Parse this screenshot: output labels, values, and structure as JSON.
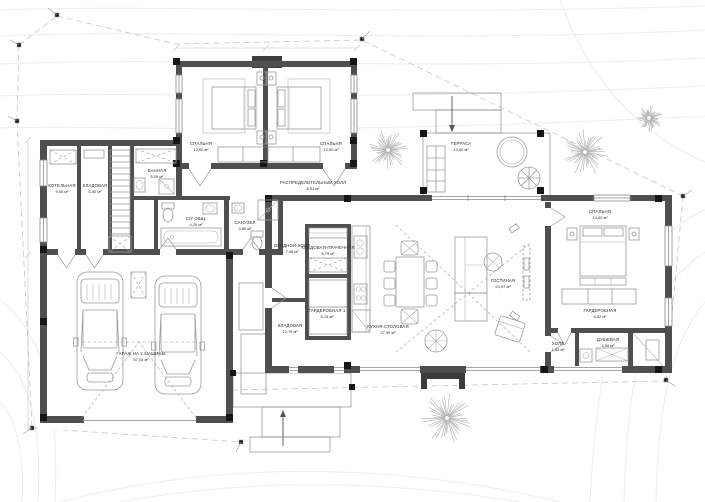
{
  "drawing": {
    "kind": "floor-plan",
    "area_unit": "м²"
  },
  "palette": {
    "wall": "#4f4f4f",
    "wall_dark": "#3c3c3c",
    "column": "#161616",
    "furniture": "#9a9a9a",
    "deck_line": "#c9c9c9",
    "contour": "#ececec",
    "label_text": "#2b2b2b",
    "background": "#ffffff"
  },
  "rooms": [
    {
      "id": "bedroom-1",
      "name": "Спальня",
      "area": "12,00 м²"
    },
    {
      "id": "bedroom-2",
      "name": "Спальня",
      "area": "12,00 м²"
    },
    {
      "id": "dist-hall",
      "name": "Распределительный холл",
      "area": "8,51 м²"
    },
    {
      "id": "boiler",
      "name": "Котельная",
      "area": "9,00 м²"
    },
    {
      "id": "pantry-left",
      "name": "Кладовая",
      "area": "6,50 м²"
    },
    {
      "id": "bath",
      "name": "Ванная",
      "area": "5,09 м²"
    },
    {
      "id": "wc-shared",
      "name": "С/у общ.",
      "area": "4,20 м²"
    },
    {
      "id": "wc-guest",
      "name": "Санузел",
      "area": "3,80 м²"
    },
    {
      "id": "entry-hall",
      "name": "Входной холл",
      "area": "7,08 м²"
    },
    {
      "id": "laundry",
      "name": "Кладовая-прачечная",
      "area": "5,79 м²"
    },
    {
      "id": "wardrobe-1",
      "name": "Гардеробная 1",
      "area": "5,13 м²"
    },
    {
      "id": "storage",
      "name": "Кладовая",
      "area": "12,79 м²"
    },
    {
      "id": "garage",
      "name": "Гараж на 2 машины",
      "area": "57,04 м²"
    },
    {
      "id": "kitchen-dining",
      "name": "Кухня-столовая",
      "area": "27,99 м²"
    },
    {
      "id": "living",
      "name": "Гостиная",
      "area": "23,97 м²"
    },
    {
      "id": "bedroom-master",
      "name": "Спальня",
      "area": "14,00 м²"
    },
    {
      "id": "wardrobe-2",
      "name": "Гардеробная",
      "area": "6,62 м²"
    },
    {
      "id": "hall-small",
      "name": "Холл",
      "area": "1,95 м²"
    },
    {
      "id": "shower",
      "name": "Душевая",
      "area": "4,50 м²"
    },
    {
      "id": "terrace",
      "name": "Терраса",
      "area": "13,00 м²"
    }
  ]
}
